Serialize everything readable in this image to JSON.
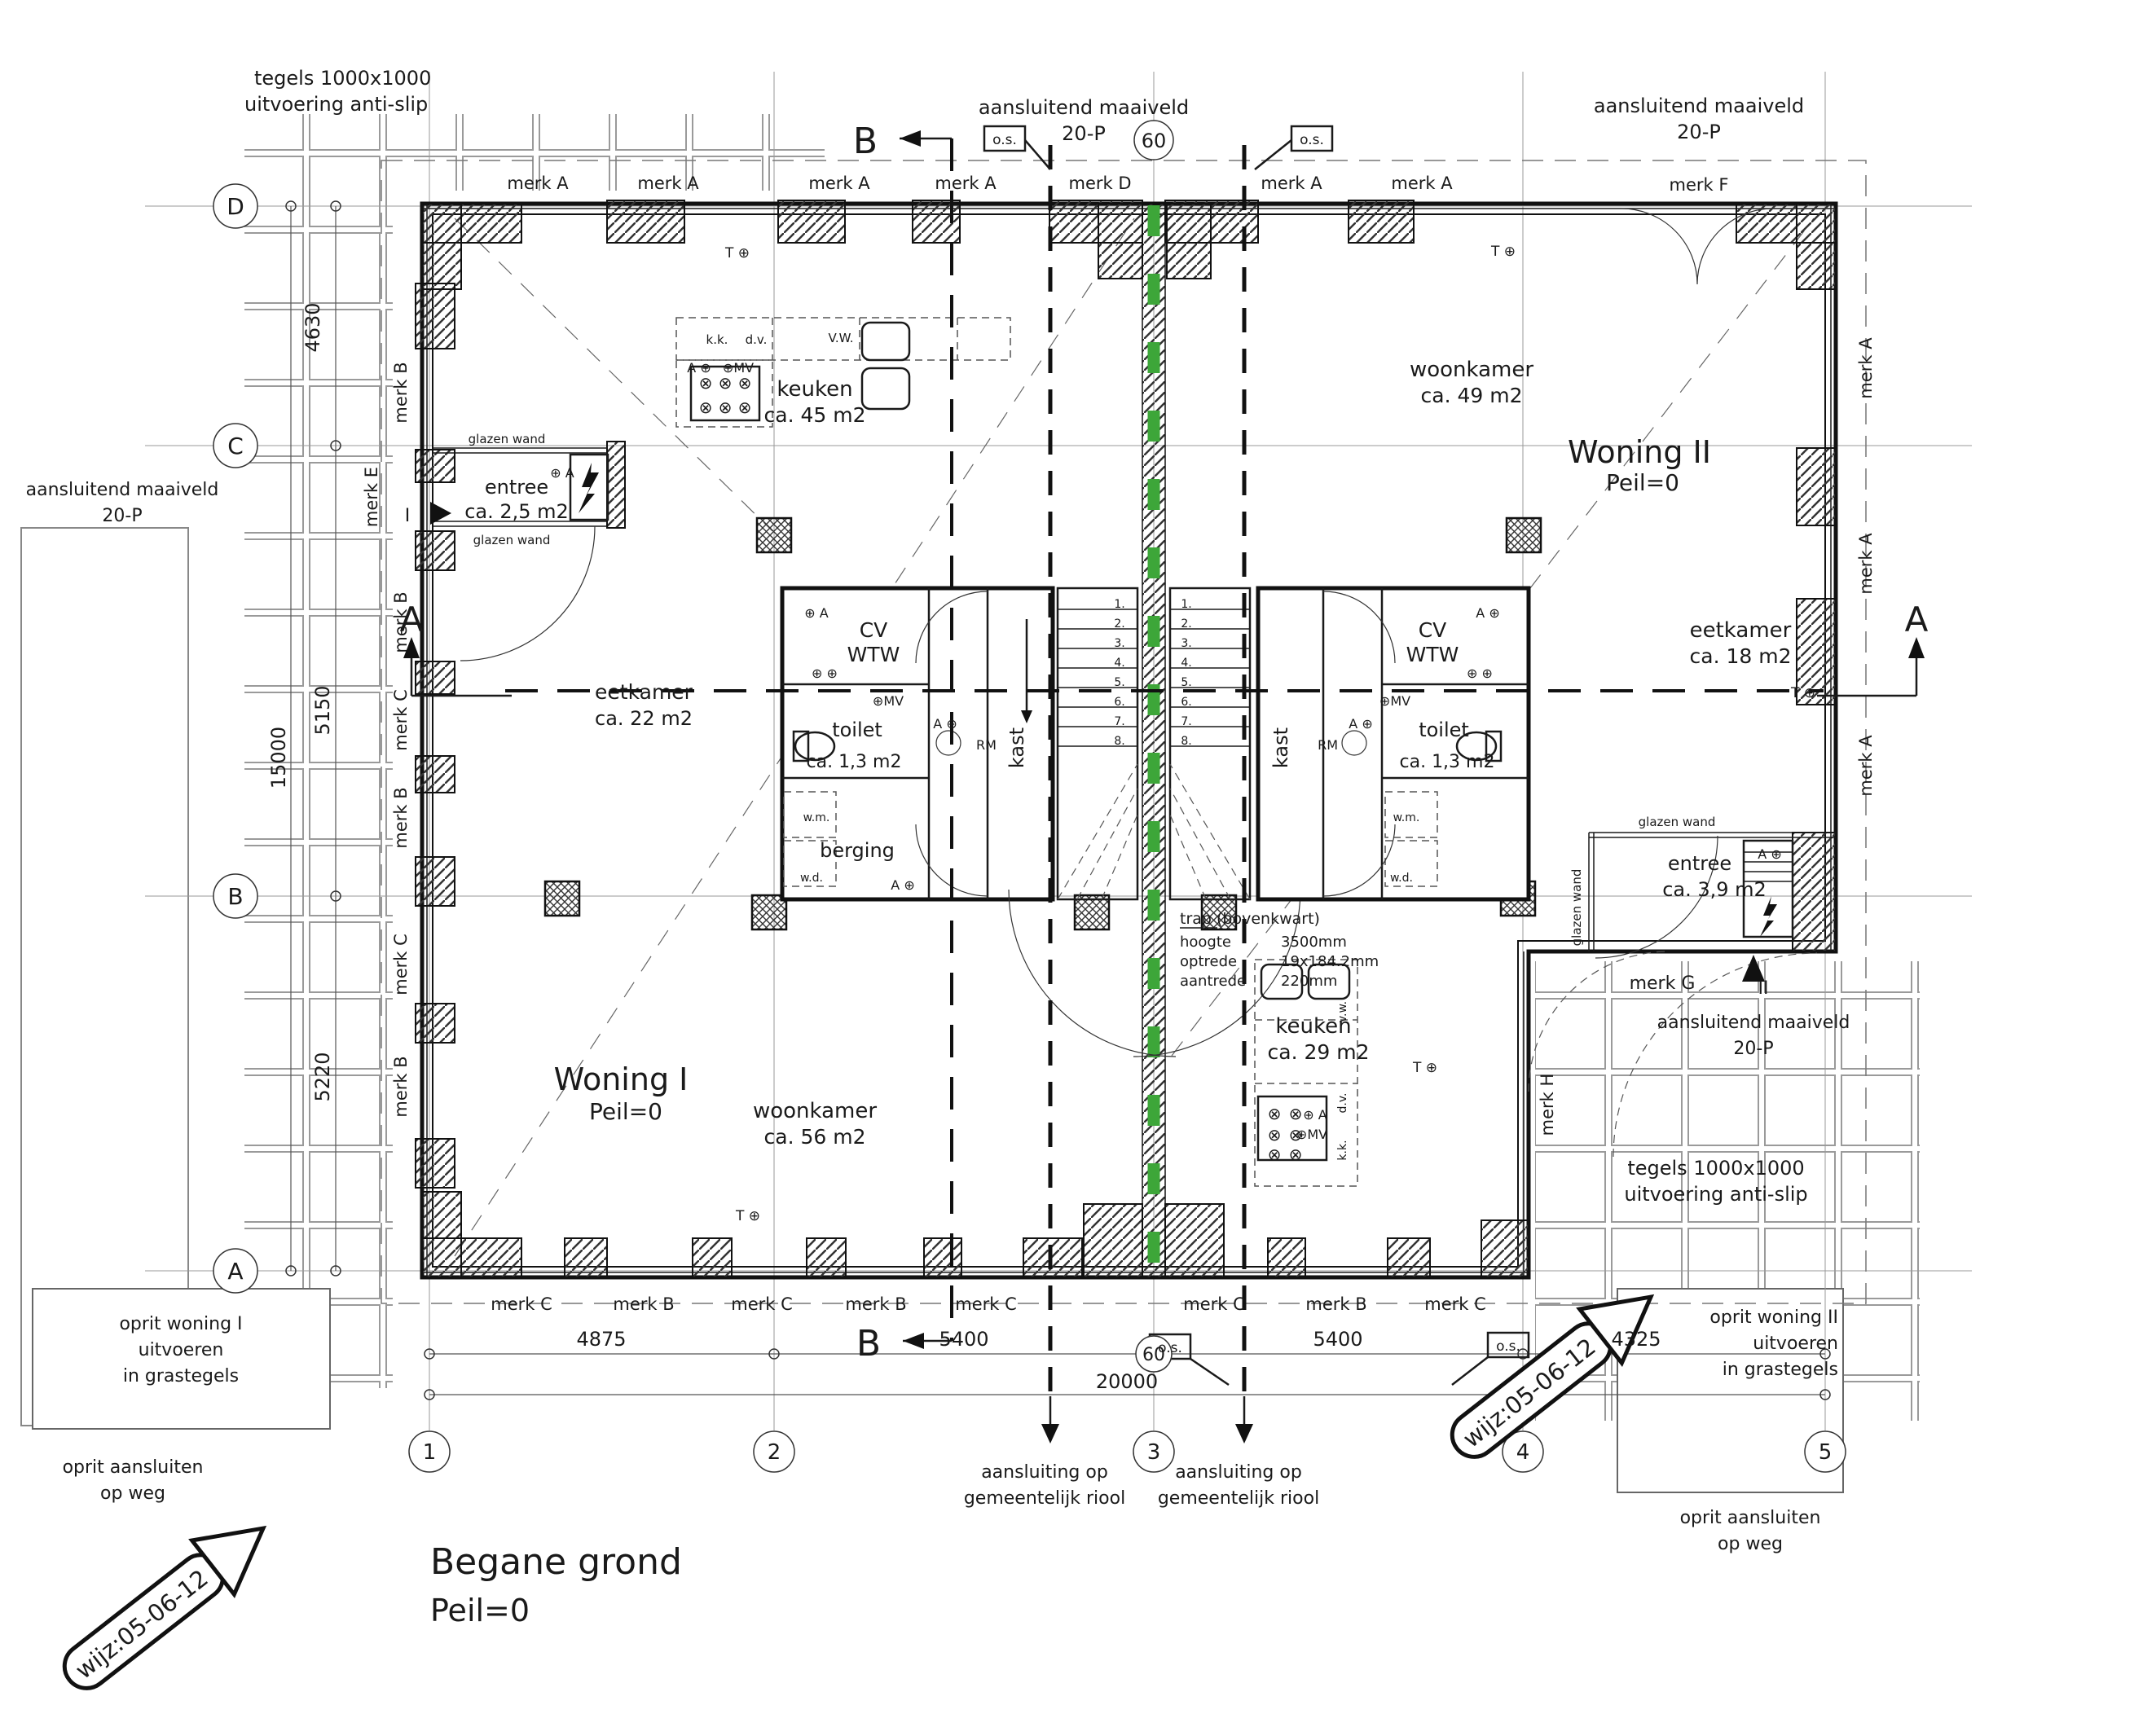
{
  "drawing_title": {
    "line1": "Begane grond",
    "line2": "Peil=0"
  },
  "colors": {
    "green": "#3DA639"
  },
  "grid": {
    "rows": [
      "D",
      "C",
      "B",
      "A"
    ],
    "cols": [
      "1",
      "2",
      "3",
      "4",
      "5"
    ],
    "riser": "60"
  },
  "dims": {
    "left": [
      "4630",
      "5150",
      "5220"
    ],
    "left_total": "15000",
    "bottom": [
      "4875",
      "5400",
      "5400",
      "4325"
    ],
    "bottom_total": "20000"
  },
  "merks": {
    "top": [
      "merk A",
      "merk A",
      "merk A",
      "merk A",
      "merk D",
      "merk A",
      "merk A"
    ],
    "top_right": "merk F",
    "left": [
      "merk B",
      "merk B",
      "merk C",
      "merk B",
      "merk C",
      "merk B"
    ],
    "left_entree": "merk E",
    "bottom": [
      "merk C",
      "merk B",
      "merk C",
      "merk B",
      "merk C",
      "merk C",
      "merk B",
      "merk C"
    ],
    "right": [
      "merk A",
      "merk A",
      "merk A"
    ],
    "entree2": "merk G",
    "glass2": "merk H"
  },
  "notes": {
    "tiles1": "tegels 1000x1000",
    "tiles2": "uitvoering anti-slip",
    "maaiveld1": "aansluitend maaiveld",
    "maaiveld2": "20-P",
    "os": "o.s.",
    "glazen_wand": "glazen wand",
    "section_a": "A",
    "section_b": "B"
  },
  "woning1": {
    "name": "Woning I",
    "peil": "Peil=0",
    "entree": "entree",
    "entree_area": "ca. 2,5 m2",
    "entree_marker": "I",
    "eetkamer": "eetkamer",
    "eetkamer_area": "ca. 22 m2",
    "keuken": "keuken",
    "keuken_area": "ca. 45 m2",
    "woonkamer": "woonkamer",
    "woonkamer_area": "ca. 56 m2"
  },
  "woning2": {
    "name": "Woning II",
    "peil": "Peil=0",
    "entree": "entree",
    "entree_area": "ca. 3,9 m2",
    "entree_marker": "II",
    "eetkamer": "eetkamer",
    "eetkamer_area": "ca. 18 m2",
    "keuken": "keuken",
    "keuken_area": "ca. 29 m2",
    "woonkamer": "woonkamer",
    "woonkamer_area": "ca. 49 m2"
  },
  "core": {
    "cv": "CV",
    "wtw": "WTW",
    "toilet": "toilet",
    "toilet_area": "ca. 1,3 m2",
    "berging": "berging",
    "kast": "kast",
    "wm": "w.m.",
    "wd": "w.d.",
    "rm": "RM"
  },
  "kitchen": {
    "kk": "k.k.",
    "dv": "d.v.",
    "vw_caps": "V.W.",
    "vw": "v.w."
  },
  "symbols": {
    "a_plus": "A ⊕",
    "plus_a": "⊕ A",
    "mv": "⊕MV",
    "t": "T ⊕",
    "pp": "⊕ ⊕"
  },
  "stairs": {
    "numbers": [
      "1.",
      "2.",
      "3.",
      "4.",
      "5.",
      "6.",
      "7.",
      "8."
    ]
  },
  "trap": {
    "title": "trap (bovenkwart)",
    "l1": "hoogte",
    "v1": "3500mm",
    "l2": "optrede",
    "v2": "19x184.2mm",
    "l3": "aantrede",
    "v3": "220mm"
  },
  "site": {
    "oprit1": [
      "oprit woning I",
      "uitvoeren",
      "in grastegels"
    ],
    "oprit2": [
      "oprit woning II",
      "uitvoeren",
      "in grastegels"
    ],
    "oprit_weg1": "oprit aansluiten",
    "oprit_weg2": "op weg",
    "riool1": "aansluiting op",
    "riool2": "gemeentelijk riool",
    "wijz": "wijz:05-06-12"
  }
}
